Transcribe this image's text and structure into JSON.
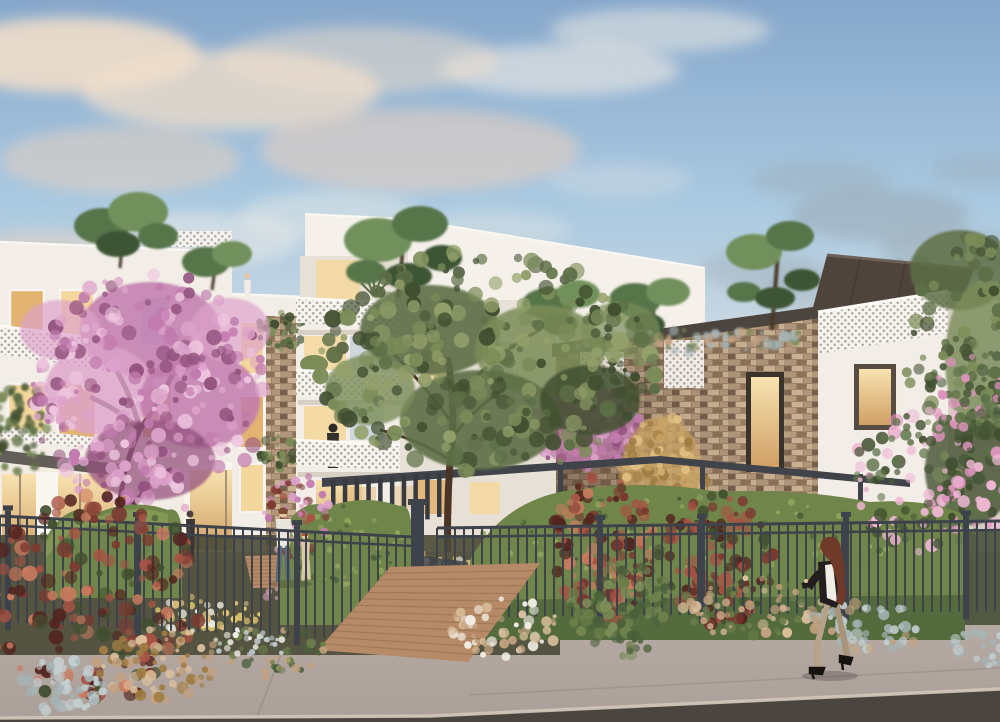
{
  "scene": {
    "kind": "architectural-rendering",
    "subject": "modern-residential-building-at-dusk"
  },
  "colors": {
    "sky_top": "#86a7cb",
    "sky_mid": "#a9c9e1",
    "sky_low": "#cdd9e2",
    "sky_horizon": "#e9e0d8",
    "cloud1": "#f0ddca",
    "cloud2": "#e6cfc0",
    "cloud_w": "#f6efe6",
    "haze": "#9aa6ad",
    "haze_g1": "#76857a",
    "haze_g2": "#93a193",
    "facade": "#f2ede6",
    "facade2": "#e7e0d6",
    "facade_side": "#d9d0c5",
    "facade_hi": "#faf7f1",
    "block_top": "#f5f1ea",
    "parapet": "#cfc6bb",
    "window_warm": "#f4d79c",
    "window_warm2": "#e3b372",
    "window_cool": "#c8d2d8",
    "frame_dark": "#5c5246",
    "frame_white": "#f8f5f0",
    "railing": "#f7f4ef",
    "fascia": "#4c453f",
    "canopy": "#4e443c",
    "canopy_hi": "#6e6157",
    "canopy_in": "#372f2a",
    "pergola": "#40444a",
    "pergola_dk": "#373b40",
    "fence": "#3e434b",
    "stone_bg": "#9d8168",
    "stone_a": "#b0967b",
    "stone_b": "#8c7259",
    "stone_c": "#c9b192",
    "stone_d": "#75604c",
    "hedge": "#6f8549",
    "hedge_hi": "#93a85c",
    "hedge_dk": "#49603a",
    "tree_g1": "#5d6f46",
    "tree_g2": "#7b8c58",
    "tree_g3": "#414f30",
    "tree_g4": "#93a06a",
    "pine1": "#57744a",
    "pine2": "#71905c",
    "pine3": "#3d5535",
    "pink1": "#c27bae",
    "pink2": "#dda2cb",
    "pink3": "#eec6df",
    "pink4": "#94537f",
    "gold1": "#c9a364",
    "gold2": "#e0c181",
    "gold3": "#a07c42",
    "photinia": "#7b3a31",
    "photinia2": "#a85243",
    "photinia3": "#cb7a5f",
    "photinia_dk": "#52241f",
    "oleander_g": "#47593a",
    "oleander_g2": "#5f744a",
    "oleander_pk": "#dd93bd",
    "oleander_pk2": "#f0b9d6",
    "grass_tan": "#c3a17f",
    "grass_tan2": "#dcc09c",
    "grass_green": "#6d7f4a",
    "silver": "#a4b4b6",
    "silver2": "#c3ced0",
    "flower_y": "#ecd36e",
    "flower_p": "#e2a6c6",
    "flower_w": "#f2efe6",
    "wood": "#b68a66",
    "wood_dk": "#8e6a4c",
    "wood_lt": "#cfa57f",
    "walk": "#ab9f99",
    "walk_lt": "#bcb1a9",
    "joint": "#8b807b",
    "street": "#4b4540",
    "curb": "#cfc5b8",
    "ground_dk": "#4a4a36",
    "ground_dk2": "#465038",
    "trunk": "#4a3426",
    "trunk_pink": "#5c3a44",
    "skin": "#e8c4a4",
    "hair_auburn": "#6f3a2a",
    "jacket_dk": "#241f1e",
    "blouse": "#f0ece6",
    "pants": "#b7a289",
    "jeans": "#5a6a80",
    "shirt_w": "#e9e6de",
    "child_cl": "#d9c9a8",
    "fig_dk": "#3a3633"
  },
  "clouds": [
    [
      70,
      55,
      130,
      38,
      "cloud1",
      0.9
    ],
    [
      230,
      90,
      150,
      40,
      "cloud1",
      0.75
    ],
    [
      420,
      150,
      160,
      42,
      "cloud2",
      0.6
    ],
    [
      120,
      160,
      120,
      34,
      "cloud2",
      0.55
    ],
    [
      40,
      255,
      90,
      26,
      "cloud2",
      0.5
    ],
    [
      190,
      240,
      110,
      28,
      "cloud_w",
      0.45
    ],
    [
      330,
      215,
      90,
      24,
      "cloud_w",
      0.4
    ],
    [
      560,
      70,
      120,
      26,
      "cloud_w",
      0.55
    ],
    [
      660,
      30,
      110,
      22,
      "cloud_w",
      0.5
    ],
    [
      490,
      230,
      80,
      20,
      "cloud_w",
      0.3
    ],
    [
      620,
      180,
      70,
      18,
      "cloud_w",
      0.25
    ],
    [
      110,
      330,
      100,
      24,
      "cloud2",
      0.35
    ],
    [
      20,
      370,
      80,
      20,
      "cloud1",
      0.3
    ],
    [
      360,
      60,
      140,
      34,
      "cloud1",
      0.5
    ],
    [
      880,
      215,
      90,
      26,
      "haze",
      0.5
    ],
    [
      950,
      250,
      70,
      20,
      "haze",
      0.45
    ],
    [
      820,
      180,
      70,
      18,
      "haze",
      0.35
    ],
    [
      990,
      170,
      60,
      16,
      "haze",
      0.3
    ],
    [
      760,
      270,
      60,
      20,
      "haze",
      0.35
    ],
    [
      830,
      290,
      70,
      22,
      "haze",
      0.3
    ]
  ],
  "fences": {
    "left": {
      "x1": 0,
      "y1": 516,
      "x2": 412,
      "y2": 537,
      "gap": 9,
      "len": 106,
      "posts": [
        8,
        138,
        297
      ]
    },
    "right": {
      "x1": 437,
      "y1": 528,
      "x2": 1000,
      "y2": 521,
      "gap": 9,
      "len": 90,
      "posts": [
        600,
        702,
        846,
        966
      ]
    }
  },
  "fins": {
    "pergola": {
      "x1": 331,
      "y1": 480,
      "x2": 437,
      "y2": 473,
      "n": 10,
      "h1": 58,
      "h2": 44
    }
  },
  "boardwalks": {
    "outer": {
      "corners": [
        [
          318,
          650
        ],
        [
          390,
          567
        ],
        [
          540,
          563
        ],
        [
          468,
          662
        ]
      ],
      "n": 13
    },
    "inner": {
      "corners": [
        [
          252,
          588
        ],
        [
          245,
          556
        ],
        [
          425,
          551
        ],
        [
          432,
          586
        ]
      ],
      "n": 9
    }
  },
  "specks": {
    "bgTreeE": {
      "cx": 898,
      "cy": 300,
      "rx": 55,
      "ry": 42,
      "n": 60,
      "r1": 3,
      "r2": 7,
      "seed": 42,
      "colors": [
        "haze_g1",
        "haze_g2",
        "tree_g1"
      ]
    },
    "greenL": {
      "cx": 18,
      "cy": 428,
      "rx": 30,
      "ry": 48,
      "n": 50,
      "r1": 2.5,
      "r2": 6,
      "seed": 39,
      "colors": [
        "tree_g1",
        "tree_g3",
        "tree_g2"
      ]
    },
    "pillarVine": {
      "cx": 281,
      "cy": 330,
      "rx": 24,
      "ry": 20,
      "n": 35,
      "r1": 2,
      "r2": 5,
      "seed": 40,
      "colors": [
        "tree_g2",
        "tree_g1",
        "tree_g3"
      ]
    },
    "pillarVine2": {
      "cx": 280,
      "cy": 452,
      "rx": 20,
      "ry": 16,
      "n": 28,
      "r1": 2,
      "r2": 5,
      "seed": 41,
      "colors": [
        "tree_g2",
        "tree_g3",
        "tree_g1"
      ]
    },
    "vineD": {
      "cx": 612,
      "cy": 392,
      "rx": 26,
      "ry": 58,
      "n": 55,
      "r1": 2,
      "r2": 5,
      "seed": 22,
      "colors": [
        "tree_g3",
        "tree_g1",
        "silver"
      ]
    },
    "roofTufts": {
      "cx": 688,
      "cy": 340,
      "rx": 128,
      "ry": 13,
      "n": 60,
      "r1": 2,
      "r2": 6,
      "seed": 23,
      "colors": [
        "silver",
        "tree_g2",
        "tree_g1",
        "grass_tan"
      ]
    },
    "pinktree1": {
      "cx": 148,
      "cy": 392,
      "rx": 118,
      "ry": 122,
      "n": 260,
      "r1": 2.5,
      "r2": 8,
      "seed": 11,
      "colors": [
        "pink1",
        "pink2",
        "pink3",
        "pink4"
      ]
    },
    "pinktree2": {
      "cx": 585,
      "cy": 426,
      "rx": 55,
      "ry": 44,
      "n": 90,
      "r1": 2,
      "r2": 6,
      "seed": 12,
      "colors": [
        "pink1",
        "pink2",
        "pink4"
      ]
    },
    "goldbush": {
      "cx": 662,
      "cy": 482,
      "rx": 46,
      "ry": 70,
      "n": 100,
      "r1": 2.5,
      "r2": 6.5,
      "seed": 16,
      "colors": [
        "gold1",
        "gold2",
        "gold3"
      ]
    },
    "greentree": {
      "cx": 488,
      "cy": 362,
      "rx": 172,
      "ry": 112,
      "n": 270,
      "r1": 3,
      "r2": 9,
      "seed": 14,
      "colors": [
        "tree_g1",
        "tree_g2",
        "tree_g3",
        "tree_g4"
      ]
    },
    "righttree": {
      "cx": 978,
      "cy": 368,
      "rx": 72,
      "ry": 135,
      "n": 150,
      "r1": 3,
      "r2": 8,
      "seed": 15,
      "colors": [
        "tree_g1",
        "tree_g3",
        "tree_g2"
      ]
    },
    "hedgeTexC": {
      "cx": 345,
      "cy": 545,
      "rx": 60,
      "ry": 40,
      "n": 50,
      "r1": 1.5,
      "r2": 3.5,
      "seed": 37,
      "colors": [
        "hedge_hi",
        "hedge_dk"
      ]
    },
    "hedgeTexR": {
      "cx": 700,
      "cy": 540,
      "rx": 220,
      "ry": 45,
      "n": 120,
      "r1": 1.5,
      "r2": 3.5,
      "seed": 38,
      "colors": [
        "hedge_hi",
        "hedge_dk",
        "hedge"
      ]
    },
    "photC1": {
      "cx": 603,
      "cy": 548,
      "rx": 52,
      "ry": 74,
      "n": 120,
      "r1": 2.5,
      "r2": 7,
      "seed": 18,
      "colors": [
        "photinia",
        "photinia2",
        "photinia3",
        "photinia_dk"
      ]
    },
    "photC2": {
      "cx": 716,
      "cy": 558,
      "rx": 58,
      "ry": 68,
      "n": 120,
      "r1": 2.5,
      "r2": 7,
      "seed": 19,
      "colors": [
        "photinia",
        "photinia2",
        "photinia_dk",
        "tree_g3"
      ]
    },
    "oleander": {
      "cx": 930,
      "cy": 482,
      "rx": 82,
      "ry": 72,
      "n": 140,
      "r1": 2.5,
      "r2": 7,
      "seed": 20,
      "colors": [
        "oleander_g",
        "oleander_g2",
        "oleander_pk",
        "oleander_pk2",
        "tree_g3"
      ]
    },
    "oleander2": {
      "cx": 972,
      "cy": 392,
      "rx": 42,
      "ry": 46,
      "n": 60,
      "r1": 2.5,
      "r2": 6,
      "seed": 21,
      "colors": [
        "oleander_g2",
        "oleander_g",
        "oleander_pk"
      ]
    },
    "pinksmall": {
      "cx": 296,
      "cy": 515,
      "rx": 34,
      "ry": 42,
      "n": 60,
      "r1": 2,
      "r2": 5,
      "seed": 13,
      "colors": [
        "pink2",
        "pink1",
        "photinia2",
        "photinia"
      ]
    },
    "flowerY": {
      "cx": 203,
      "cy": 616,
      "rx": 58,
      "ry": 20,
      "n": 50,
      "r1": 1.8,
      "r2": 4.5,
      "seed": 32,
      "colors": [
        "flower_y",
        "gold2",
        "flower_w"
      ]
    },
    "flowerP": {
      "cx": 298,
      "cy": 590,
      "rx": 40,
      "ry": 20,
      "n": 40,
      "r1": 1.8,
      "r2": 4.5,
      "seed": 33,
      "colors": [
        "flower_p",
        "pink2",
        "flower_w"
      ]
    },
    "flowerY2": {
      "cx": 450,
      "cy": 573,
      "rx": 42,
      "ry": 15,
      "n": 32,
      "r1": 1.8,
      "r2": 4,
      "seed": 34,
      "colors": [
        "flower_y",
        "flower_w",
        "gold2"
      ]
    },
    "flowerW2": {
      "cx": 372,
      "cy": 566,
      "rx": 38,
      "ry": 13,
      "n": 22,
      "r1": 1.5,
      "r2": 3.5,
      "seed": 36,
      "colors": [
        "flower_w",
        "grass_tan2"
      ]
    },
    "photL": {
      "cx": 92,
      "cy": 598,
      "rx": 112,
      "ry": 104,
      "n": 190,
      "r1": 3,
      "r2": 8,
      "seed": 17,
      "colors": [
        "photinia",
        "photinia2",
        "photinia3",
        "photinia_dk",
        "tree_g3"
      ]
    },
    "grassDome": {
      "cx": 152,
      "cy": 663,
      "rx": 64,
      "ry": 38,
      "n": 80,
      "r1": 2,
      "r2": 6,
      "seed": 24,
      "colors": [
        "grass_tan",
        "grass_tan2",
        "gold3"
      ]
    },
    "santolina": {
      "cx": 62,
      "cy": 686,
      "rx": 44,
      "ry": 27,
      "n": 55,
      "r1": 2.5,
      "r2": 6,
      "seed": 25,
      "colors": [
        "silver",
        "silver2"
      ]
    },
    "greenTuftsL": {
      "cx": 268,
      "cy": 652,
      "rx": 58,
      "ry": 26,
      "n": 45,
      "r1": 2,
      "r2": 5,
      "seed": 31,
      "colors": [
        "grass_green",
        "hedge_dk",
        "grass_tan"
      ]
    },
    "flowerW": {
      "cx": 252,
      "cy": 644,
      "rx": 44,
      "ry": 12,
      "n": 26,
      "r1": 1.5,
      "r2": 3.5,
      "seed": 35,
      "colors": [
        "flower_w",
        "silver2"
      ]
    },
    "grassTanC": {
      "cx": 505,
      "cy": 628,
      "rx": 56,
      "ry": 30,
      "n": 60,
      "r1": 2,
      "r2": 5.5,
      "seed": 29,
      "colors": [
        "grass_tan",
        "grass_tan2",
        "flower_w"
      ]
    },
    "greenBushR": {
      "cx": 622,
      "cy": 608,
      "rx": 52,
      "ry": 48,
      "n": 90,
      "r1": 2.5,
      "r2": 6,
      "seed": 30,
      "colors": [
        "grass_green",
        "hedge_dk",
        "tree_g2"
      ]
    },
    "grassTanR": {
      "cx": 752,
      "cy": 608,
      "rx": 72,
      "ry": 30,
      "n": 70,
      "r1": 2,
      "r2": 5.5,
      "seed": 28,
      "colors": [
        "grass_tan",
        "grass_tan2",
        "grass_green"
      ]
    },
    "santolinaR": {
      "cx": 866,
      "cy": 628,
      "rx": 58,
      "ry": 26,
      "n": 55,
      "r1": 2.5,
      "r2": 6,
      "seed": 26,
      "colors": [
        "silver",
        "silver2",
        "grass_tan"
      ]
    },
    "santolinaR2": {
      "cx": 988,
      "cy": 648,
      "rx": 38,
      "ry": 20,
      "n": 30,
      "r1": 2.5,
      "r2": 5.5,
      "seed": 27,
      "colors": [
        "silver",
        "silver2"
      ]
    }
  }
}
